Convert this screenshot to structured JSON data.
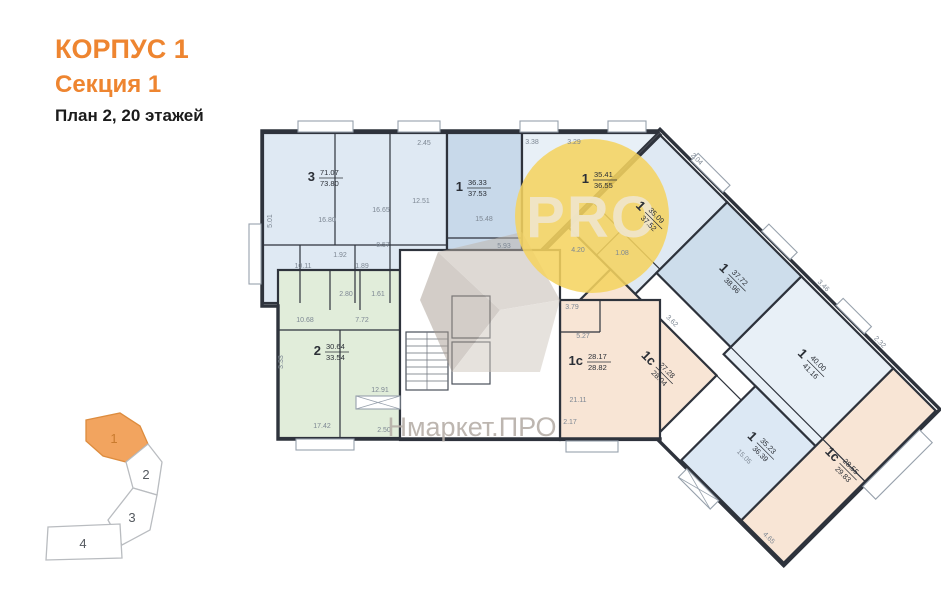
{
  "header": {
    "building": "КОРПУС 1",
    "section": "Секция 1",
    "plan_info": "План 2, 20 этажей",
    "accent_color": "#ee8530"
  },
  "watermarks": {
    "circle_text": "PRO",
    "circle_color": "#f5d35f",
    "brand_text": "Нмаркет.ПРО"
  },
  "minimap": {
    "active_color": "#f2a45f",
    "sections": [
      {
        "label": "1",
        "active": true
      },
      {
        "label": "2",
        "active": false
      },
      {
        "label": "3",
        "active": false
      },
      {
        "label": "4",
        "active": false
      }
    ]
  },
  "apartments": [
    {
      "id": "apt-3-7107",
      "type": "3",
      "living": "71.07",
      "total": "73.80",
      "color": "#dfe9f3",
      "dims": [
        "16.80",
        "16.65",
        "12.51",
        "8.57",
        "10.11",
        "1.92",
        "1.89",
        "5.01",
        "2.45"
      ]
    },
    {
      "id": "apt-1-3633",
      "type": "1",
      "living": "36.33",
      "total": "37.53",
      "color": "#c8d9ea",
      "dims": [
        "15.48",
        "5.93"
      ]
    },
    {
      "id": "apt-1-3541",
      "type": "1",
      "living": "35.41",
      "total": "36.55",
      "color": "#e8f0f7",
      "dims": [
        "4.20",
        "1.08",
        "3.38",
        "3.29"
      ]
    },
    {
      "id": "apt-1-3509",
      "type": "1",
      "living": "35.09",
      "total": "37.52",
      "color": "#dfe9f3",
      "dims": [
        "2.04"
      ]
    },
    {
      "id": "apt-1-3772",
      "type": "1",
      "living": "37.72",
      "total": "38.96",
      "color": "#cdddeb",
      "dims": [
        "3.46"
      ]
    },
    {
      "id": "apt-1-4000",
      "type": "1",
      "living": "40.00",
      "total": "41.16",
      "color": "#e8f0f7",
      "dims": [
        "2.32"
      ]
    },
    {
      "id": "apt-2-3064",
      "type": "2",
      "living": "30.64",
      "total": "33.54",
      "color": "#e1edda",
      "dims": [
        "10.68",
        "7.72",
        "17.42",
        "12.91",
        "2.80",
        "1.61",
        "3.33",
        "2.50"
      ]
    },
    {
      "id": "apt-1c-2817",
      "type": "1с",
      "living": "28.17",
      "total": "28.82",
      "color": "#f8e5d5",
      "dims": [
        "21.11",
        "5.27",
        "3.79",
        "2.17"
      ]
    },
    {
      "id": "apt-1c-2728",
      "type": "1с",
      "living": "27.28",
      "total": "28.04",
      "color": "#f8e5d5",
      "dims": [
        "3.62"
      ]
    },
    {
      "id": "apt-1-3523",
      "type": "1",
      "living": "35.23",
      "total": "36.39",
      "color": "#dce8f4",
      "dims": [
        "15.05"
      ]
    },
    {
      "id": "apt-1c-2855",
      "type": "1с",
      "living": "28.55",
      "total": "29.83",
      "color": "#f8e5d5",
      "dims": [
        "4.65"
      ]
    }
  ]
}
